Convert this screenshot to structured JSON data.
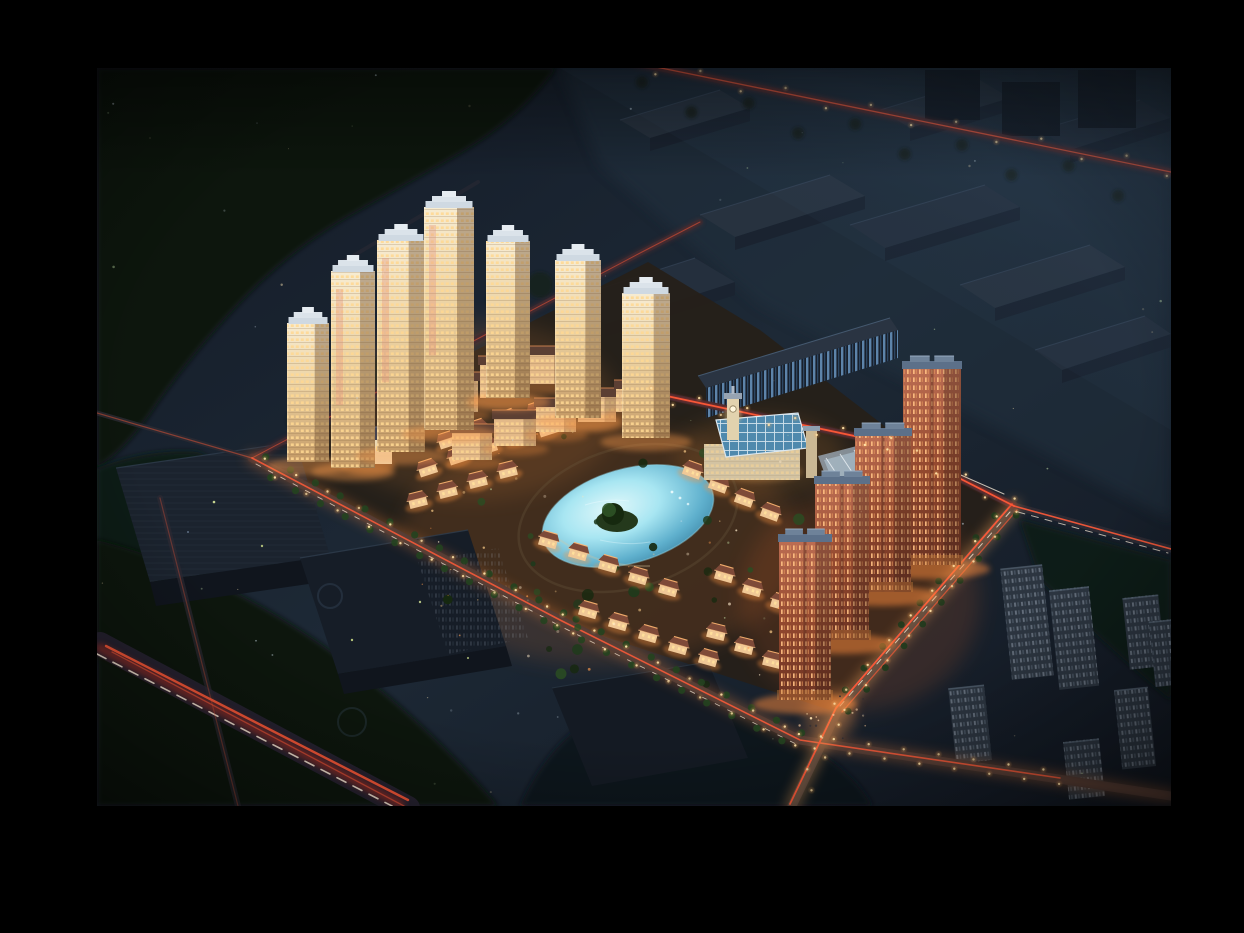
{
  "image": {
    "type": "architectural rendering photograph",
    "subject": "Aerial night view of an illuminated residential development with a central lake, framed by a black matte border",
    "time_of_day": "night",
    "view": "oblique aerial bird's-eye",
    "description": "Night-time bird's-eye rendering of a residential community: seven illuminated cream high-rise towers line the north edge, four red-brick towers with blue-grey mansard roofs step down the east side, rows of warm-lit villas surround a turquoise lake with a tree island, and a glass-roofed clubhouse with a lit clock tower sits at the north-east corner. Glowing perimeter roads carry red car-light trails, a bright highway crosses the south-west corner, dark industrial warehouses fill the north-east, unlit office blocks sit to the south-west, faint unlit apartment slabs to the south-east, with forest and scattered light specks all around, framed by a black matte border."
  },
  "scene": {
    "elements": [
      "black matte border",
      "dark night ground",
      "industrial warehouse district (north-east)",
      "blue-lit striped warehouse",
      "forest and tree belts",
      "perimeter ring road with red car-light trails",
      "highway with light trails (south-west corner)",
      "seven illuminated cream residential towers",
      "four red-brick residential towers",
      "mid-rise cluster with mansard roofs",
      "chateau-style mansion",
      "lit villa rows around the lake",
      "turquoise lake with tree island and fountain",
      "glass-roofed clubhouse",
      "clock tower",
      "white truss canopy",
      "dark office blocks (south-west)",
      "faint unlit apartment slabs (south-east)",
      "tree-lined boulevards with street lamps",
      "plaza with pedestrians near south junction",
      "ambient light specks",
      "dark vignette edges"
    ],
    "counts": {
      "cream_towers": 7,
      "red_brick_towers": 4,
      "villas": 33,
      "warehouses": 8,
      "unlit_slabs": 7
    }
  },
  "colors": {
    "matte": "#000000",
    "baseTop": "#131a26",
    "baseMid": "#1d2936",
    "baseLow": "#121822",
    "forestDark": "#0d130e",
    "forestMid": "#111b13",
    "forestGlade": "#15241c",
    "parcelGround": "#262019",
    "roadBase": "#2c2a33",
    "highwayBase": "#262230",
    "trailRed": "#ff5a38",
    "trailDeep": "#c23322",
    "trailWhite": "#fff0dc",
    "glowOrange": "#ff8a3e",
    "glowAmber": "#ffae5e",
    "lamp": "#ffe2a8",
    "lampHalo": "#ffb25e",
    "towerHi": "#f7ecd2",
    "towerLo": "#c49a66",
    "towerShade": "#5e4026",
    "winWarm": "#ffd891",
    "crown1": "#cfd9e2",
    "crown2": "#dbe3ea",
    "crown3": "#e6ecf1",
    "redHi": "#bc6d52",
    "redLo": "#6b3222",
    "redRoof": "#5c7089",
    "redRoofHi": "#9fb3c8",
    "winRed": "#ffc083",
    "villaWall": "#f0c896",
    "villaRoof": "#7e4a38",
    "villaRidge": "#ffb772",
    "lakeHi": "#e2f8fa",
    "lakeMid": "#a8e6f2",
    "lakeLo": "#2e7495",
    "island": "#24391c",
    "islandTree": "#16290f",
    "glass": "#4f89ad",
    "glassFrame": "#e8f2f8",
    "clubWall": "#d3c3a2",
    "clockTower": "#e2d2ae",
    "whRoof": "#242f3d",
    "whFace": "#1a2330",
    "whEdge": "#3c4c61",
    "blueStripe": "#6d9cc8",
    "office": "#1b232e",
    "officeFace": "#10151d",
    "slab": "#2c3540",
    "slabWin": "#b9c6d6",
    "tree": "#23421f",
    "treeLight": "#2e5226",
    "haze": "#3a5470"
  }
}
